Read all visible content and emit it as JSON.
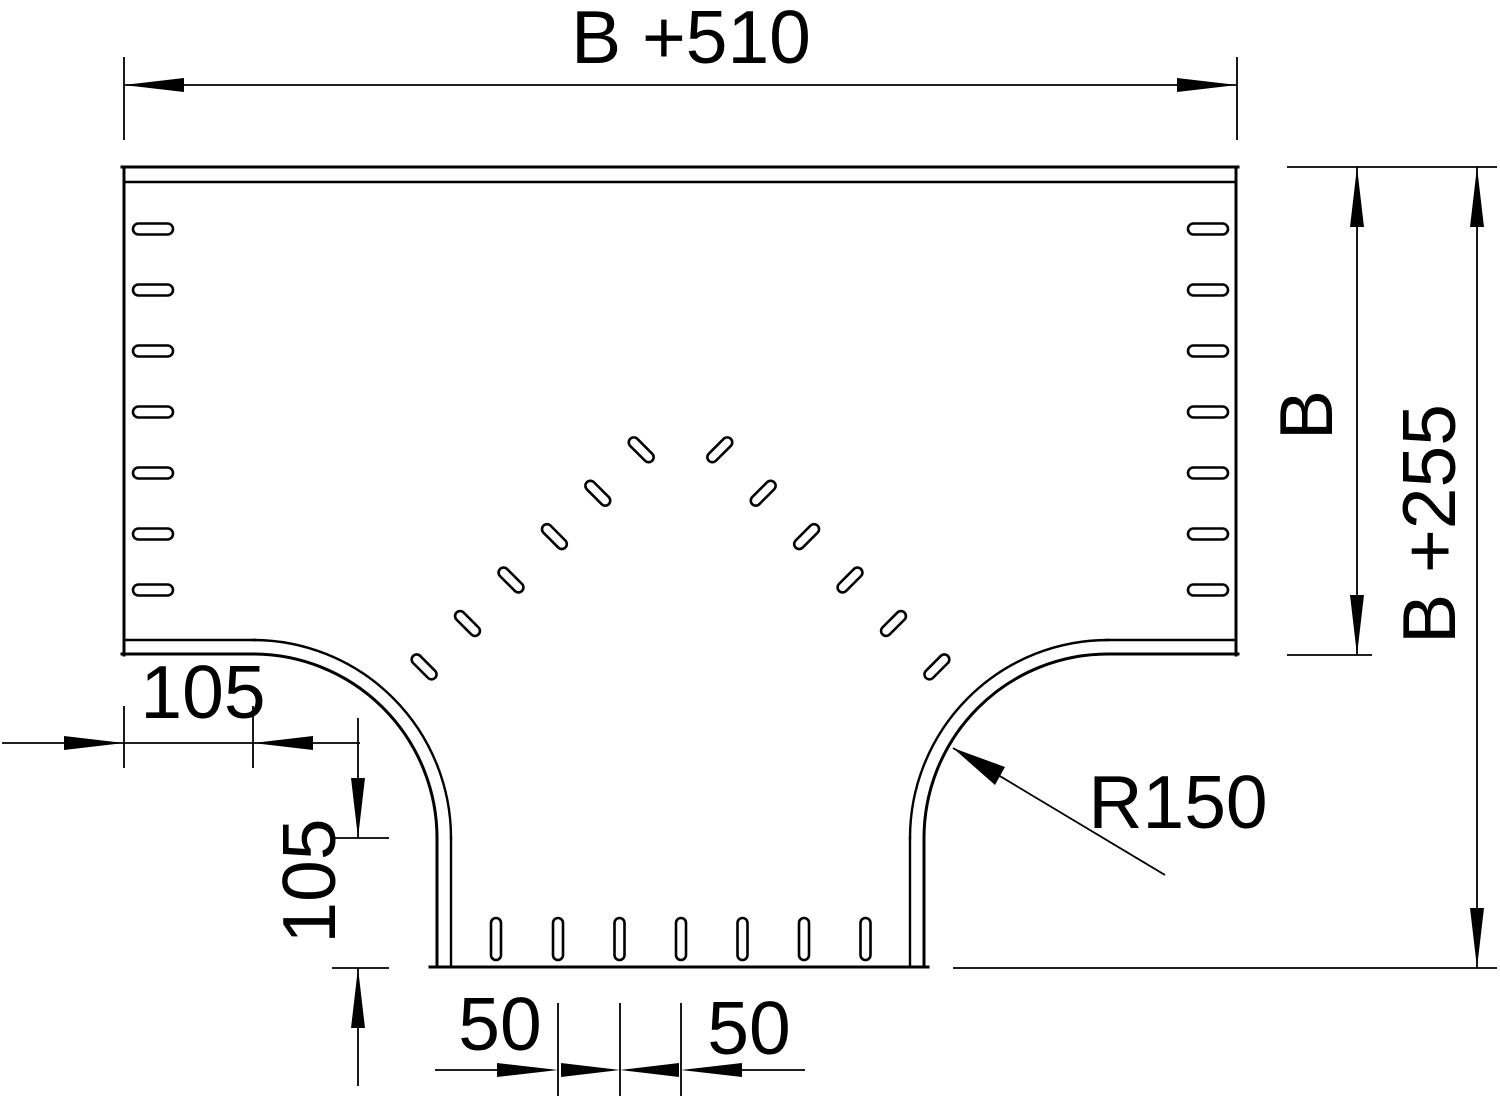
{
  "drawing": {
    "type": "technical-drawing-top-view",
    "background_color": "#ffffff",
    "line_color": "#000000",
    "labels": {
      "top_width": "B +510",
      "inner_height": "B",
      "outer_height": "B +255",
      "left_offset": "105",
      "bottom_offset": "105",
      "corner_radius": "R150",
      "pitch_left": "50",
      "pitch_right": "50"
    }
  }
}
